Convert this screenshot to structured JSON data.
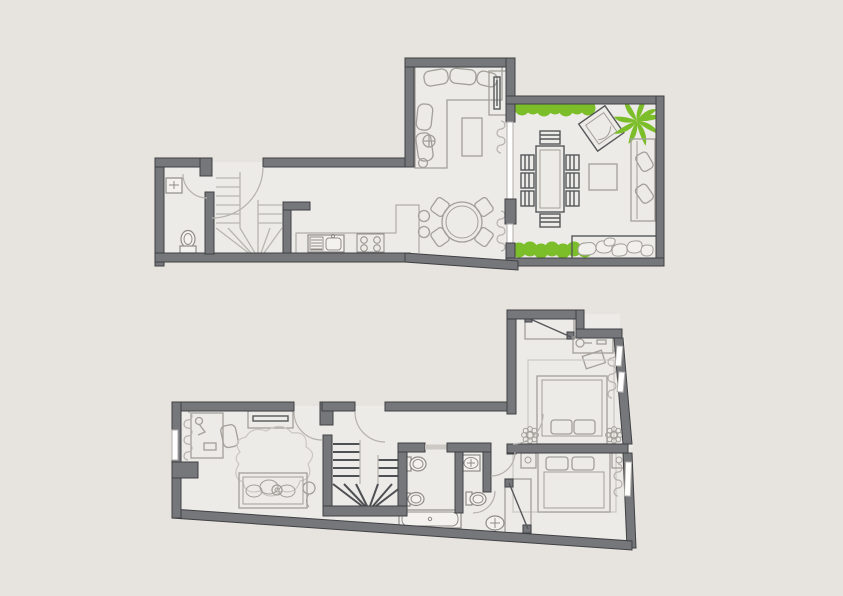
{
  "title": "duplex-apartment-floor-plan",
  "colors": {
    "background": "#e7e3de",
    "floor": "#edebe7",
    "wall": "#75777a",
    "wall_outline": "#404144",
    "furniture_line": "#a39f9b",
    "fixture_line": "#8f8c88",
    "dark_detail": "#55575a",
    "stair_tread": "#b9b6b2",
    "stair_tread_dark": "#4e5053",
    "plant_green": "#7cbd2a",
    "window_line": "#b1aeaa",
    "door_arc": "#b5b2ae",
    "rug_line": "#cac7c3"
  },
  "floors": [
    {
      "name": "upper-floor",
      "position": "top of image",
      "rooms": [
        {
          "name": "entry-hall",
          "items": [
            {
              "name": "entry-door",
              "count": 1
            },
            {
              "name": "winder-staircase",
              "count": 1
            }
          ]
        },
        {
          "name": "wc",
          "items": [
            {
              "name": "washbasin",
              "count": 1
            },
            {
              "name": "toilet",
              "count": 1
            },
            {
              "name": "door",
              "count": 1
            }
          ]
        },
        {
          "name": "kitchen",
          "items": [
            {
              "name": "l-shaped-counter",
              "count": 1
            },
            {
              "name": "sink-with-drainer",
              "count": 1
            },
            {
              "name": "cooktop-burner",
              "count": 4
            },
            {
              "name": "peninsula",
              "count": 1
            },
            {
              "name": "bar-stool",
              "count": 2
            }
          ]
        },
        {
          "name": "living-room",
          "items": [
            {
              "name": "corner-sofa",
              "count": 1
            },
            {
              "name": "sofa-cushion",
              "count": 5
            },
            {
              "name": "coffee-table",
              "count": 1
            },
            {
              "name": "floor-lamp",
              "count": 1
            },
            {
              "name": "tv-cabinet",
              "count": 1
            },
            {
              "name": "round-dining-table",
              "count": 1
            },
            {
              "name": "dining-chair",
              "count": 4
            },
            {
              "name": "curtain",
              "count": 2
            },
            {
              "name": "sliding-door-panel",
              "count": 1
            }
          ]
        },
        {
          "name": "terrace",
          "items": [
            {
              "name": "hedge",
              "count": 2
            },
            {
              "name": "outdoor-dining-table",
              "count": 1
            },
            {
              "name": "outdoor-chair",
              "count": 8
            },
            {
              "name": "lounge-chair",
              "count": 1
            },
            {
              "name": "side-table",
              "count": 1
            },
            {
              "name": "palm-tree",
              "count": 1
            },
            {
              "name": "outdoor-sofa",
              "count": 1
            },
            {
              "name": "pebble-planter",
              "count": 1
            }
          ]
        }
      ]
    },
    {
      "name": "lower-floor",
      "position": "bottom of image",
      "rooms": [
        {
          "name": "kids-room",
          "items": [
            {
              "name": "desk",
              "count": 1
            },
            {
              "name": "desk-lamp",
              "count": 1
            },
            {
              "name": "desk-chair",
              "count": 1
            },
            {
              "name": "wall-tv",
              "count": 1
            },
            {
              "name": "cloud-rug",
              "count": 1
            },
            {
              "name": "daybed",
              "count": 1
            },
            {
              "name": "cushion",
              "count": 3
            },
            {
              "name": "balloon",
              "count": 1
            },
            {
              "name": "window",
              "count": 1
            },
            {
              "name": "curtain",
              "count": 1
            }
          ]
        },
        {
          "name": "landing-hall",
          "items": [
            {
              "name": "door",
              "count": 3
            },
            {
              "name": "winder-staircase",
              "count": 1
            }
          ]
        },
        {
          "name": "bathroom",
          "items": [
            {
              "name": "wall-hung-toilet",
              "count": 1
            },
            {
              "name": "bidet",
              "count": 1
            },
            {
              "name": "bathtub",
              "count": 1
            },
            {
              "name": "pocket-door",
              "count": 1
            }
          ]
        },
        {
          "name": "guest-wc",
          "items": [
            {
              "name": "counter-washbasin",
              "count": 1
            },
            {
              "name": "wall-hung-toilet",
              "count": 1
            },
            {
              "name": "door",
              "count": 1
            }
          ]
        },
        {
          "name": "vestibule",
          "items": [
            {
              "name": "pedestal-washbasin",
              "count": 1
            },
            {
              "name": "door",
              "count": 1
            }
          ]
        },
        {
          "name": "master-bedroom",
          "items": [
            {
              "name": "sliding-wardrobe",
              "count": 1
            },
            {
              "name": "desk",
              "count": 1
            },
            {
              "name": "desk-lamp",
              "count": 1
            },
            {
              "name": "desk-chair",
              "count": 1
            },
            {
              "name": "double-bed",
              "count": 1
            },
            {
              "name": "pillow",
              "count": 2
            },
            {
              "name": "plant-stand",
              "count": 2
            },
            {
              "name": "rug",
              "count": 1
            },
            {
              "name": "window",
              "count": 2
            },
            {
              "name": "curtain",
              "count": 1
            }
          ]
        },
        {
          "name": "bedroom-2",
          "items": [
            {
              "name": "double-bed",
              "count": 1
            },
            {
              "name": "pillow",
              "count": 2
            },
            {
              "name": "nightstand",
              "count": 2
            },
            {
              "name": "sliding-wardrobe",
              "count": 1
            },
            {
              "name": "rug",
              "count": 1
            },
            {
              "name": "window",
              "count": 1
            },
            {
              "name": "curtain",
              "count": 1
            }
          ]
        }
      ]
    }
  ]
}
